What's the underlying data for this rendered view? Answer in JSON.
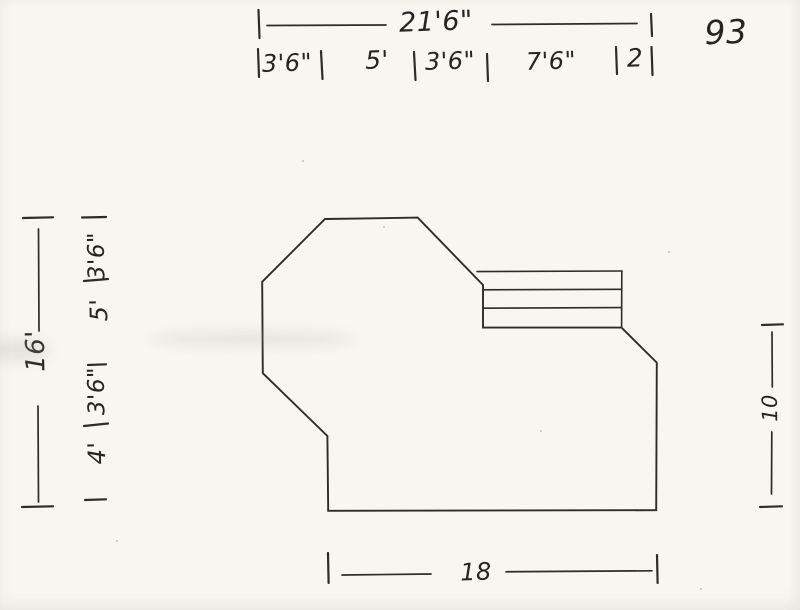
{
  "page": {
    "number": "93"
  },
  "colors": {
    "paper": "#f8f6f1",
    "ink": "#2e2c2a"
  },
  "dimensions": {
    "top": {
      "overall": "21'6\"",
      "segments": [
        "3'6\"",
        "5'",
        "3'6\"",
        "7'6\"",
        "2"
      ]
    },
    "left": {
      "overall": "16'",
      "segments": [
        "3'6\"",
        "5'",
        "3'6\"",
        "4'"
      ]
    },
    "right": {
      "value": "10"
    },
    "bottom": {
      "value": "18"
    }
  }
}
